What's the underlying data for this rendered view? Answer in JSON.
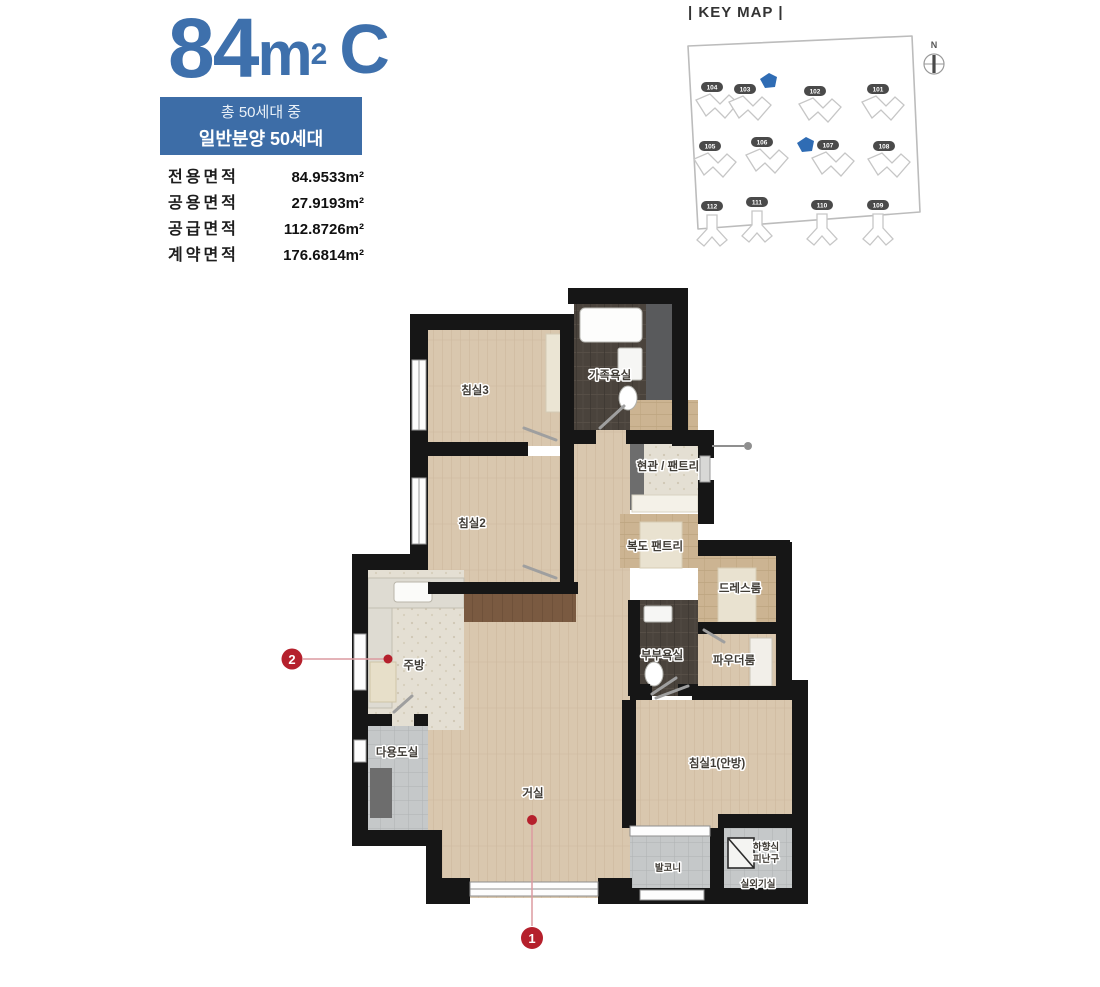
{
  "unit": {
    "area_value": "84",
    "area_unit_base": "m",
    "area_unit_sup": "2",
    "type_label": "C"
  },
  "badge": {
    "line1": "총 50세대 중",
    "line2": "일반분양 50세대"
  },
  "area_table": {
    "rows": [
      {
        "label": "전용면적",
        "value": "84.9533m²"
      },
      {
        "label": "공용면적",
        "value": "27.9193m²"
      },
      {
        "label": "공급면적",
        "value": "112.8726m²"
      },
      {
        "label": "계약면적",
        "value": "176.6814m²"
      }
    ]
  },
  "key_map": {
    "title": "| KEY MAP |",
    "compass_label": "N",
    "buildings": [
      {
        "no": "104"
      },
      {
        "no": "103"
      },
      {
        "no": "102"
      },
      {
        "no": "101"
      },
      {
        "no": "105"
      },
      {
        "no": "106"
      },
      {
        "no": "107"
      },
      {
        "no": "108"
      },
      {
        "no": "112"
      },
      {
        "no": "111"
      },
      {
        "no": "110"
      },
      {
        "no": "109"
      }
    ],
    "highlighted_buildings": [
      "103",
      "107"
    ],
    "highlight_color": "#2f6cb4"
  },
  "floor_plan": {
    "rooms": {
      "bedroom3": "침실3",
      "family_bath": "가족욕실",
      "entrance_pantry": "현관 / 팬트리",
      "bedroom2": "침실2",
      "corridor_pantry": "복도 팬트리",
      "dressroom": "드레스룸",
      "master_bath": "부부욕실",
      "powder_room": "파우더룸",
      "kitchen": "주방",
      "utility": "다용도실",
      "living": "거실",
      "bedroom1": "침실1(안방)",
      "balcony": "발코니",
      "evac_hatch_line1": "하향식",
      "evac_hatch_line2": "피난구",
      "outdoor_unit": "실외기실"
    },
    "markers": [
      {
        "num": "1"
      },
      {
        "num": "2"
      }
    ]
  },
  "colors": {
    "accent_blue": "#3d6da7",
    "marker_red": "#b5202c"
  }
}
